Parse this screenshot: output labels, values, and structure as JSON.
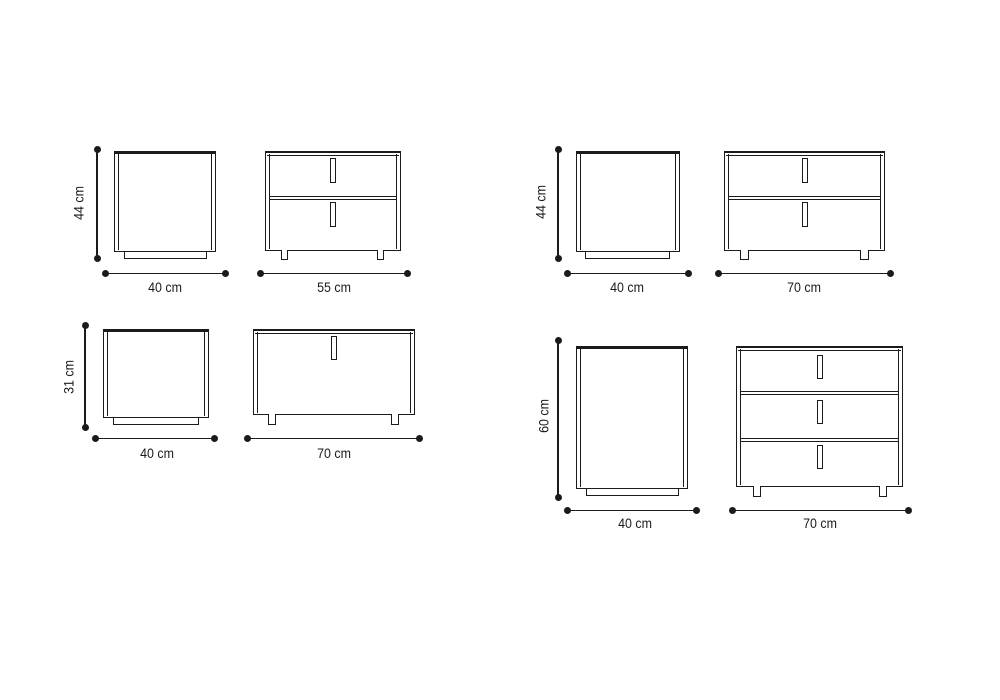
{
  "diagram": {
    "type": "furniture-dimension-drawing",
    "subject": "Nightstand and dresser elevations (side view and front view) with dimension lines",
    "unit": "cm",
    "line_color": "#1b1b1b",
    "background_color": "#ffffff",
    "groups": [
      {
        "position": "top-left",
        "height_label": "44 cm",
        "side_width_label": "40 cm",
        "front_width_label": "55 cm",
        "drawer_count": 2
      },
      {
        "position": "top-right",
        "height_label": "44 cm",
        "side_width_label": "40 cm",
        "front_width_label": "70 cm",
        "drawer_count": 2
      },
      {
        "position": "bottom-left",
        "height_label": "31 cm",
        "side_width_label": "40 cm",
        "front_width_label": "70 cm",
        "drawer_count": 1
      },
      {
        "position": "bottom-right",
        "height_label": "60 cm",
        "side_width_label": "40 cm",
        "front_width_label": "70 cm",
        "drawer_count": 3
      }
    ]
  }
}
